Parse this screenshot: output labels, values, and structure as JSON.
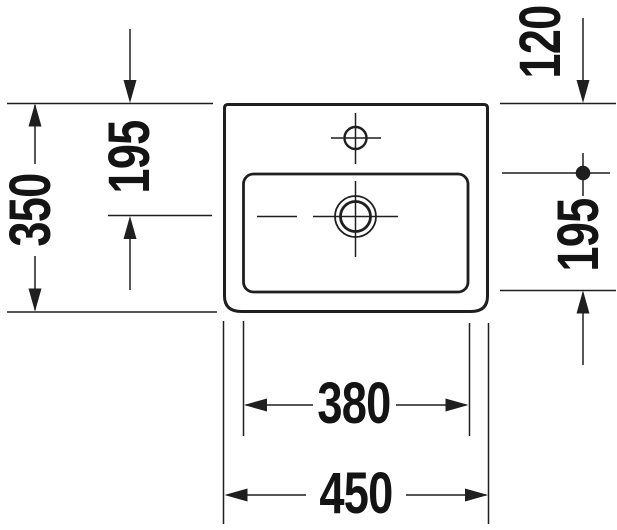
{
  "drawing": {
    "colors": {
      "line": "#1f1f1f",
      "text": "#141414",
      "background": "#ffffff"
    },
    "shapes": {
      "basin_outline": "rounded-rectangle",
      "inner_bowl": "rounded-rectangle",
      "faucet_hole": "circle-with-crosshair",
      "drain": "double-circle-with-crosshair",
      "reference_point": "filled-dot"
    }
  },
  "dimensions": {
    "left_outer": {
      "value": "350"
    },
    "left_inner": {
      "value": "195"
    },
    "right_top": {
      "value": "120"
    },
    "right_side": {
      "value": "195"
    },
    "bottom_inner": {
      "value": "380"
    },
    "bottom_outer": {
      "value": "450"
    }
  }
}
